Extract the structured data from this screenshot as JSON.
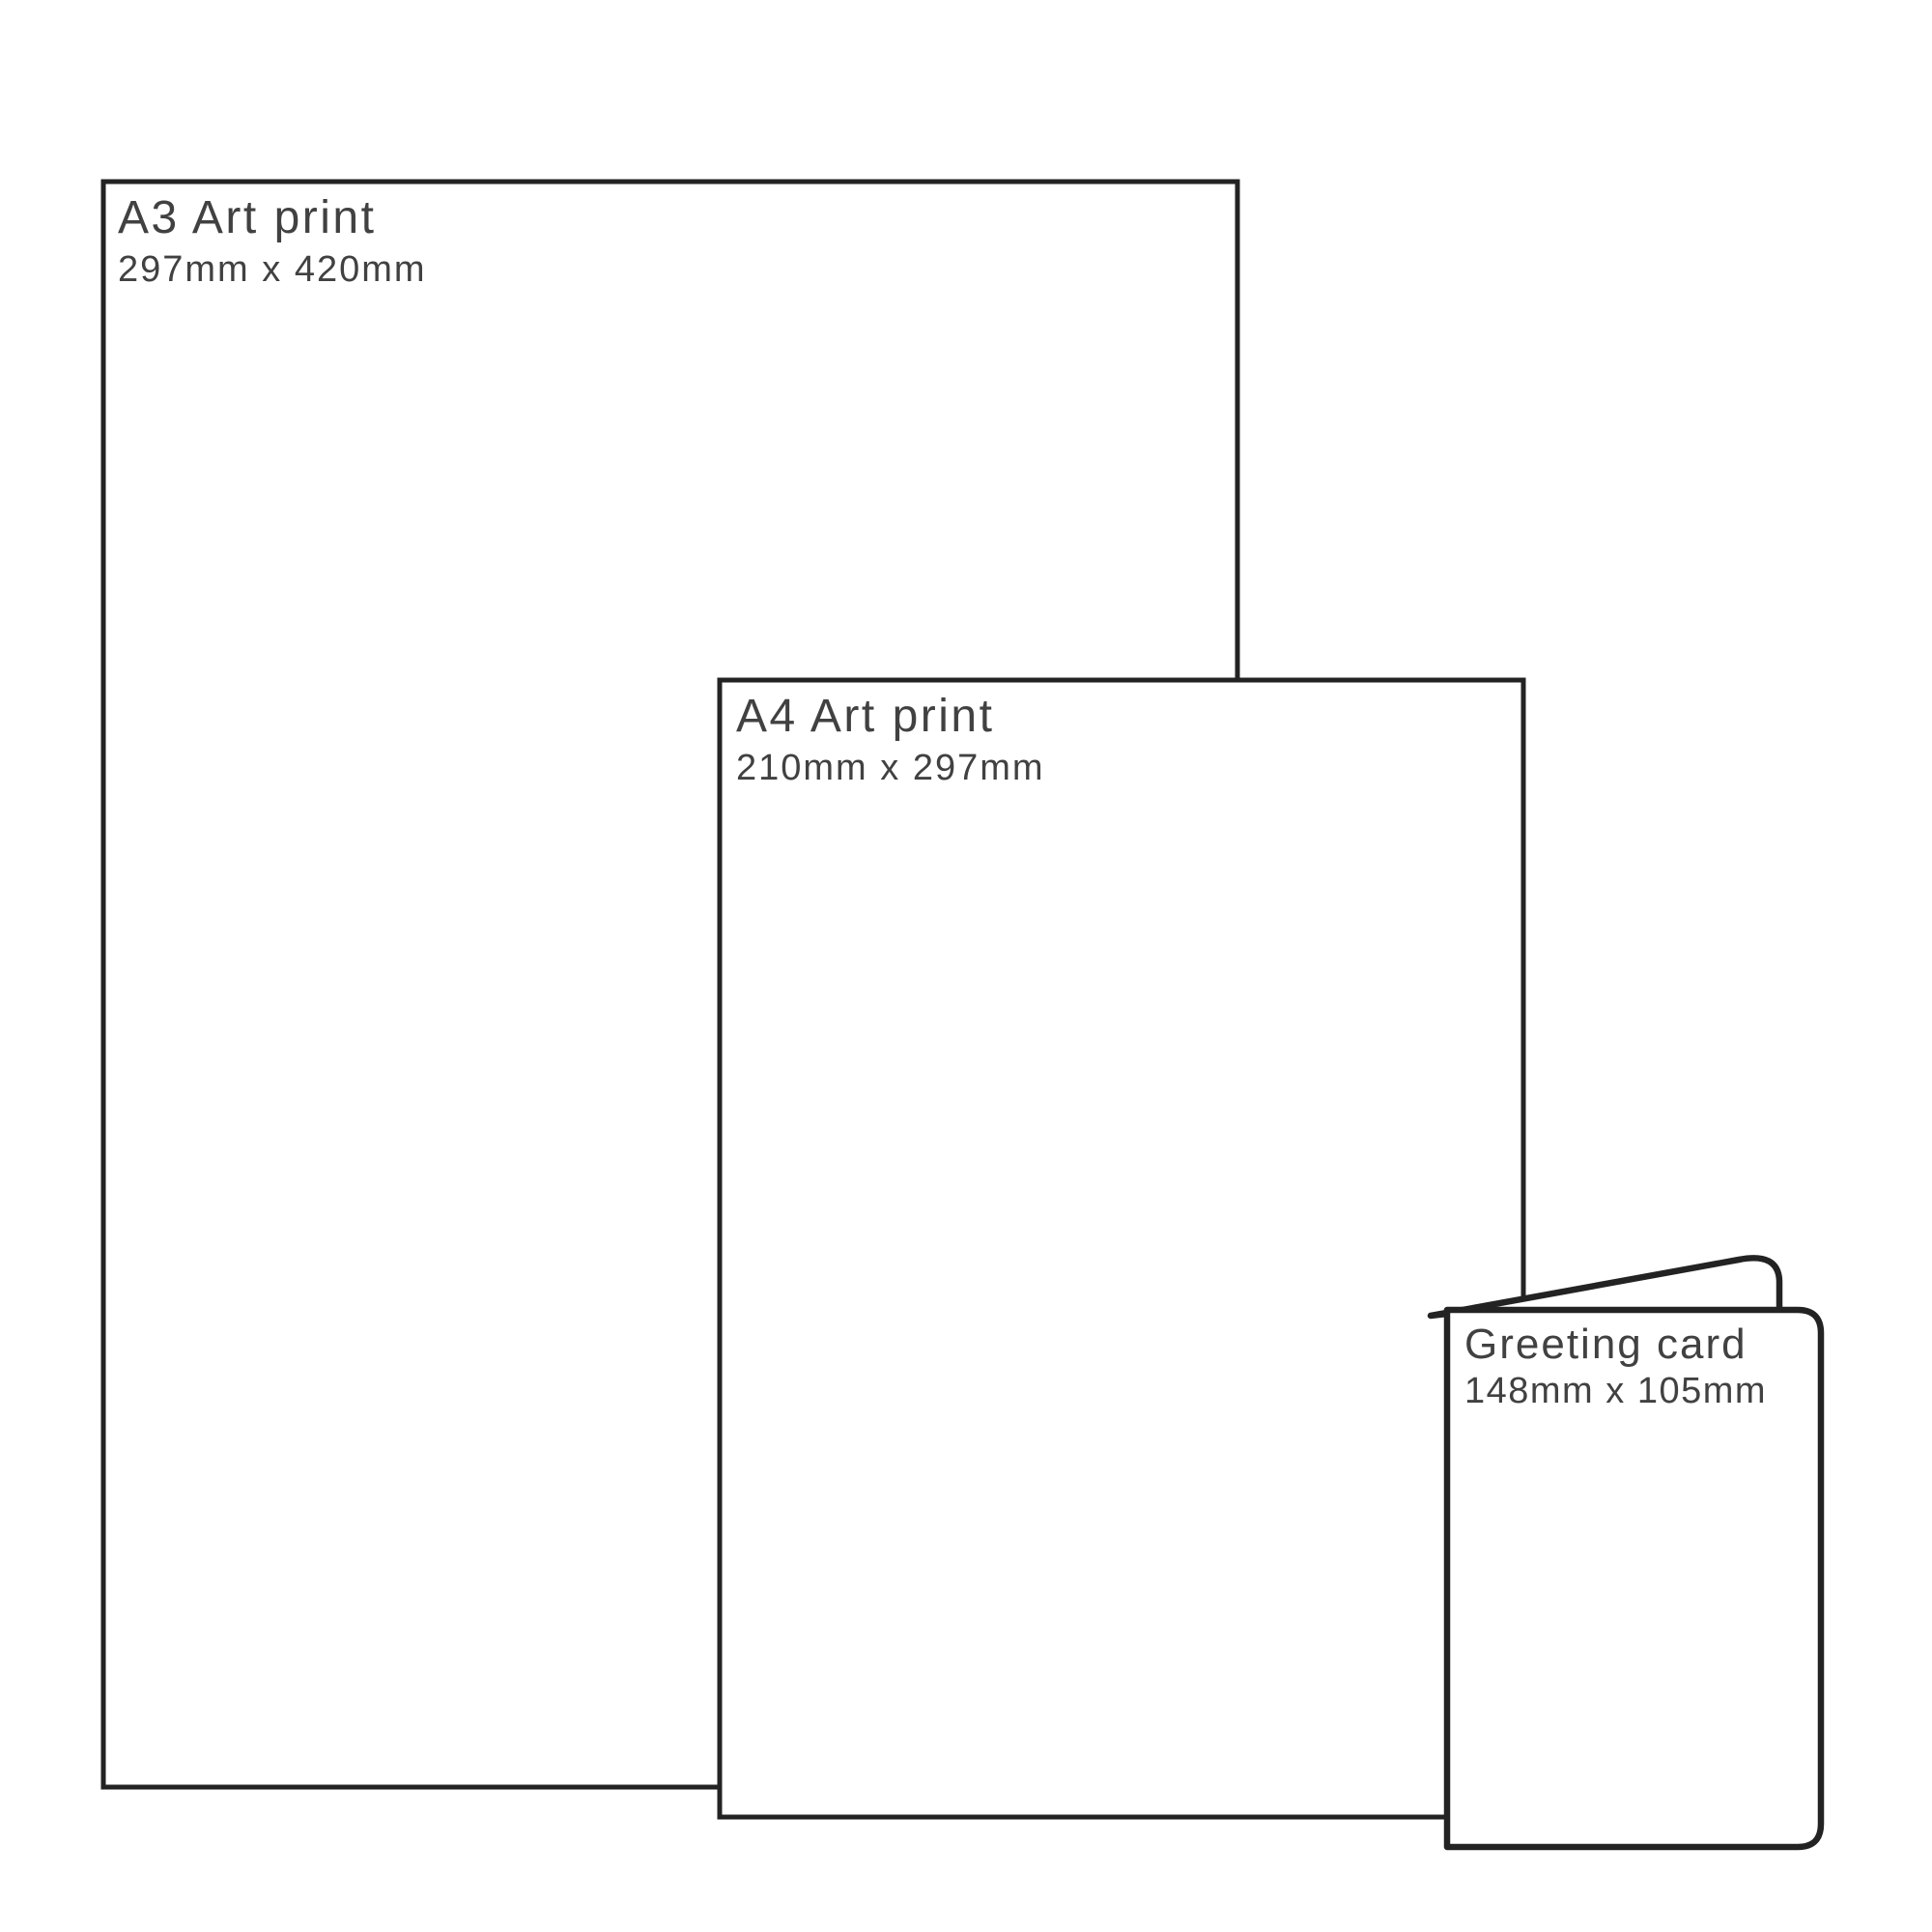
{
  "page": {
    "background": "#ffffff",
    "description": "Print size comparison diagram"
  },
  "colors": {
    "outline": "#232323",
    "text": "#414141",
    "fill": "#ffffff"
  },
  "panels": [
    {
      "id": "a3",
      "title": "A3 Art print",
      "size": "297mm x 420mm"
    },
    {
      "id": "a4",
      "title": "A4 Art print",
      "size": "210mm x 297mm"
    },
    {
      "id": "card",
      "title": "Greeting card",
      "size": "148mm x 105mm"
    }
  ]
}
